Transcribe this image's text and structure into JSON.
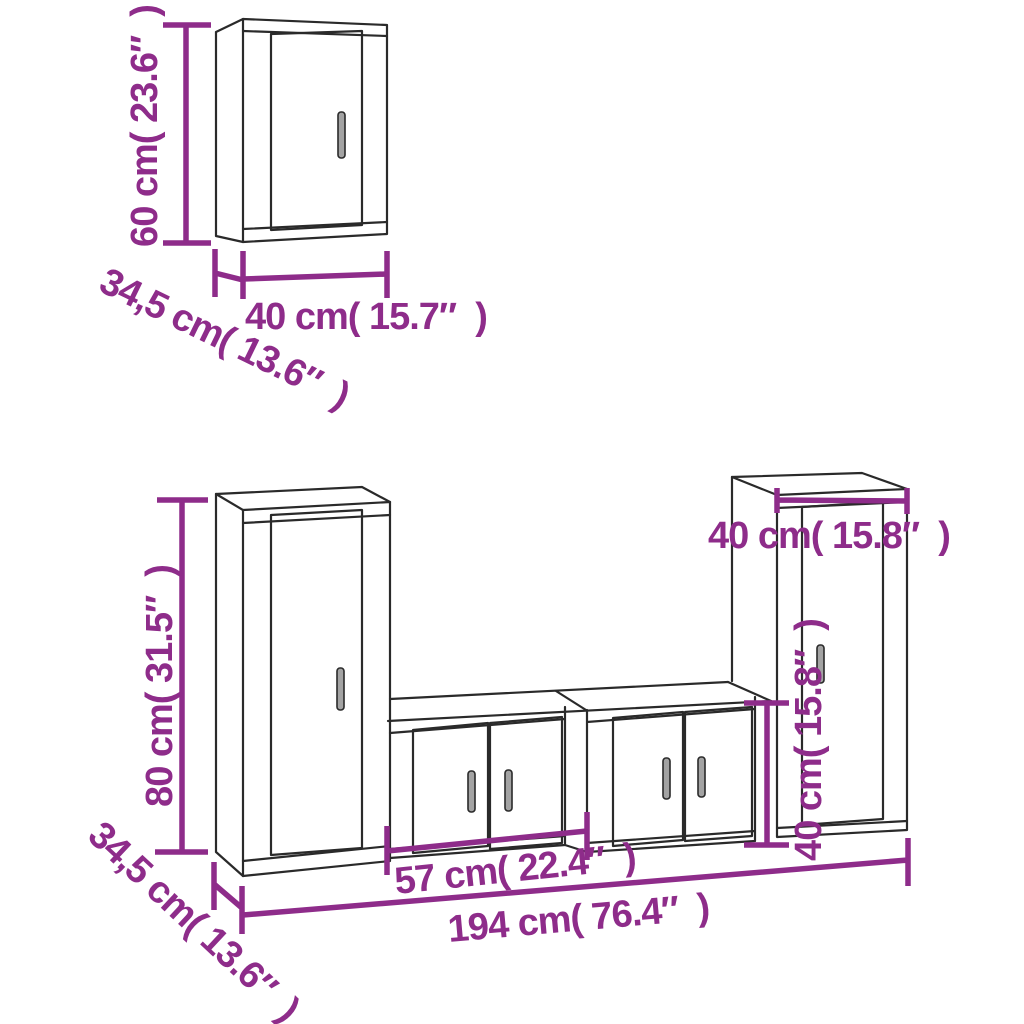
{
  "diagram": {
    "title": "Furniture dimension diagram — 5-piece TV wall cabinet set",
    "background": "#ffffff",
    "accent_color": "#8e2c8a",
    "outline_color": "#2a2a2a",
    "wall_cabinet": {
      "name": "Wall cabinet (top drawing)",
      "height_label": "60 cm( 23.6″  )",
      "depth_label": "34,5 cm( 13.6″  )",
      "width_label": "40 cm( 15.7″  )"
    },
    "tv_wall_set": {
      "name": "TV wall unit set (bottom drawing)",
      "tall_cabinet_height_label": "80 cm( 31.5″  )",
      "depth_label": "34,5 cm( 13.6″  )",
      "low_cabinet_width_label": "57 cm( 22.4″  )",
      "total_width_label": "194 cm( 76.4″  )",
      "right_cabinet_width_label": "40 cm( 15.8″  )",
      "low_cabinet_height_label": "40 cm( 15.8″  )"
    }
  }
}
